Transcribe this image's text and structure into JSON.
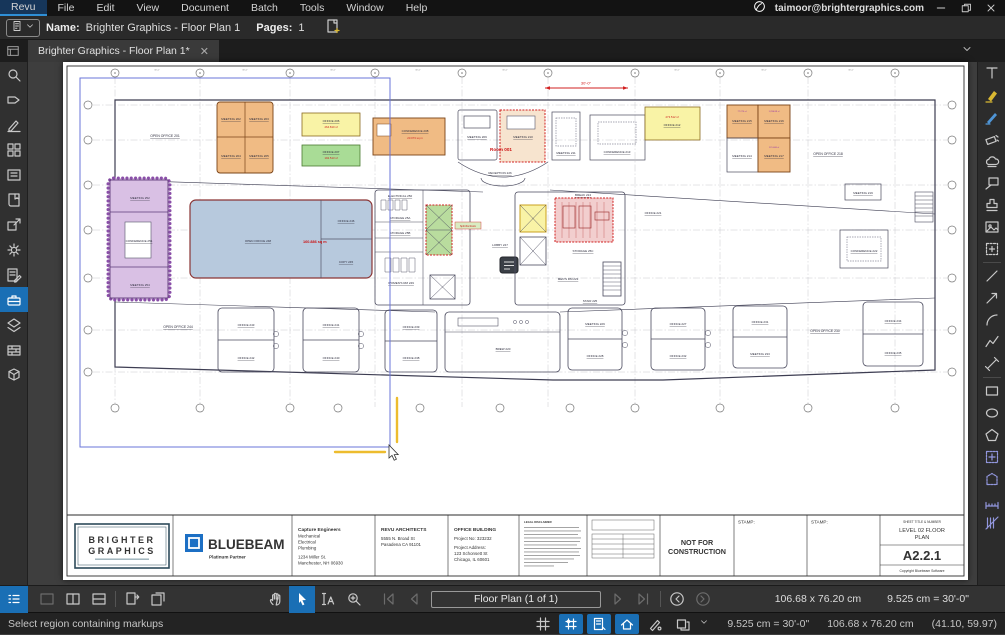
{
  "menu_bar": {
    "items": [
      "Revu",
      "File",
      "Edit",
      "View",
      "Document",
      "Batch",
      "Tools",
      "Window",
      "Help"
    ],
    "user_email": "taimoor@brightergraphics.com"
  },
  "doc_bar": {
    "name_label": "Name:",
    "name_value": "Brighter Graphics - Floor Plan 1",
    "pages_label": "Pages:",
    "pages_value": "1"
  },
  "tab_bar": {
    "active_tab": "Brighter Graphics - Floor Plan 1*",
    "close_glyph": "✕"
  },
  "bottom_toolbar": {
    "page_indicator": "Floor Plan (1 of 1)",
    "page_size": "106.68 x 76.20 cm",
    "scale": "9.525 cm = 30'-0\""
  },
  "status_bar": {
    "message": "Select region containing markups",
    "scale": "9.525 cm = 30'-0\"",
    "page_size": "106.68 x 76.20 cm",
    "cursor_coords": "(41.10, 59.97)"
  },
  "title_block": {
    "logo_line1": "BRIGHTER",
    "logo_line2": "GRAPHICS",
    "bluebeam": "BLUEBEAM",
    "bluebeam_sub": "Platinum Partner",
    "engineer": {
      "name": "Capture Engineers",
      "lines": [
        "Mechanical",
        "Electrical",
        "Plumbing",
        "1234 Miller St.",
        "Manchester, NH 06930"
      ]
    },
    "architect": {
      "name": "REVU ARCHITECTS",
      "lines": [
        "5555 N. Broad St",
        "Pasadena CA 91101"
      ]
    },
    "project": {
      "name": "OFFICE BUILDING",
      "lines": [
        "Project No: 323232",
        "Project Address:",
        "123 Schonsett St",
        "Chicago, IL 60601"
      ]
    },
    "legal_heading": "LEGAL DISCLAIMER",
    "nfc_line1": "NOT FOR",
    "nfc_line2": "CONSTRUCTION",
    "stamp1": "STAMP:",
    "stamp2": "STAMP:",
    "sheet_meta": "SHEET TITLE & NUMBER",
    "sheet_title1": "LEVEL 02 FLOOR",
    "sheet_title2": "PLAN",
    "sheet_number": "A2.2.1",
    "copyright": "Copyright Bluebeam Software"
  },
  "plan": {
    "rooms": {
      "open_office_201": "OPEN OFFICE 201",
      "meeting_202": "MEETING 202",
      "meeting_203": "MEETING 203",
      "meeting_204": "MEETING 204",
      "meeting_205": "MEETING 205",
      "office_206": "OFFICE 206",
      "office_207": "OFFICE 207",
      "conference_208": "CONFERENCE 208",
      "meeting_209": "MEETING 209",
      "meeting_210": "MEETING 210",
      "meeting_211": "MEETING 211",
      "office_212": "OFFICE 212",
      "conference_213": "CONFERENCE 213",
      "reception_226": "RECEPTION 226",
      "meeting_214": "MEETING 214",
      "meeting_215": "MEETING 215",
      "meeting_216": "MEETING 216",
      "meeting_217": "MEETING 217",
      "open_office_218": "OPEN OFFICE 218",
      "meeting_219": "MEETING 219",
      "office_221": "OFFICE 221",
      "conference_222": "CONFERENCE 222",
      "open_office_248": "OPEN OFFICE 248",
      "office_246": "OFFICE 246",
      "copy_245": "COPY 245",
      "electrical_250": "ELECTRICAL 250",
      "storage_25a": "STORAGE 25A",
      "storage_25b": "STORAGE 25B",
      "womens_rm_249": "WOMEN'S RM 249",
      "lobby_247": "LOBBY 247",
      "break_224": "BREAK 224",
      "storage_25c": "STORAGE 25C",
      "mens_rm_223": "MEN'S RM 223",
      "stair_225": "STAIR 225",
      "brew_220": "BREW 220",
      "open_office_244": "OPEN OFFICE 244",
      "office_243": "OFFICE 243",
      "office_242": "OFFICE 242",
      "office_241": "OFFICE 241",
      "office_240": "OFFICE 240",
      "office_239": "OFFICE 239",
      "office_238": "OFFICE 238",
      "open_office_230": "OPEN OFFICE 230",
      "meeting_229": "MEETING 229",
      "office_228": "OFFICE 228",
      "office_227": "OFFICE 227",
      "office_232": "OFFICE 232",
      "office_231": "OFFICE 231",
      "meeting_233": "MEETING 233",
      "office_234": "OFFICE 234",
      "office_235": "OFFICE 235",
      "meeting_252": "MEETING 252",
      "conference_251": "CONFERENCE 251",
      "meeting_254": "MEETING 254"
    },
    "areas": {
      "office_206": "264.810 sf",
      "office_207": "192.513 sf",
      "conference_208": "23.073 sq m",
      "office_212": "273.512 sf",
      "open_office_248": "160.886 sq m",
      "meeting_215": "77.276 sf",
      "meeting_216": "1,296.89 sf",
      "meeting_217": "121.468 sf"
    },
    "annotations": {
      "room_001": "Room 001",
      "split_room": "Split this Room",
      "dim_30": "30'-0\""
    }
  }
}
